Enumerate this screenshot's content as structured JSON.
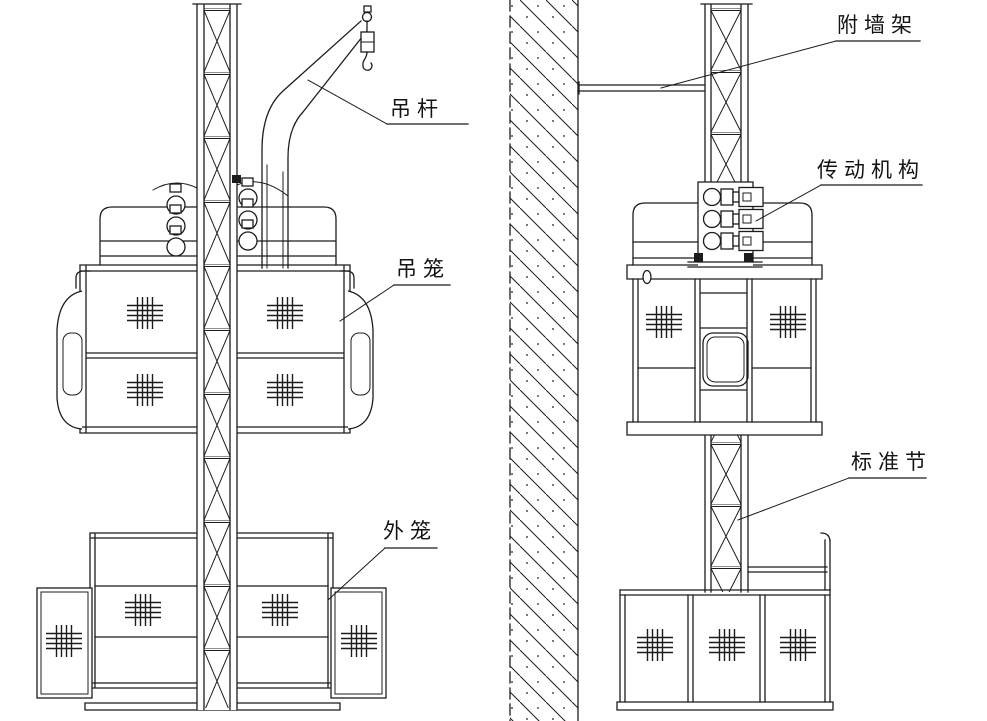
{
  "diagram": {
    "type": "technical-line-drawing",
    "subject": "construction hoist elevator, front view and side view",
    "labels": {
      "boom": "吊杆",
      "cage": "吊笼",
      "outer_cage": "外笼",
      "wall_attachment_frame": "附墙架",
      "drive_mechanism": "传动机构",
      "standard_section": "标准节"
    },
    "colors": {
      "line": "#1c1c1c",
      "background": "#ffffff"
    }
  }
}
